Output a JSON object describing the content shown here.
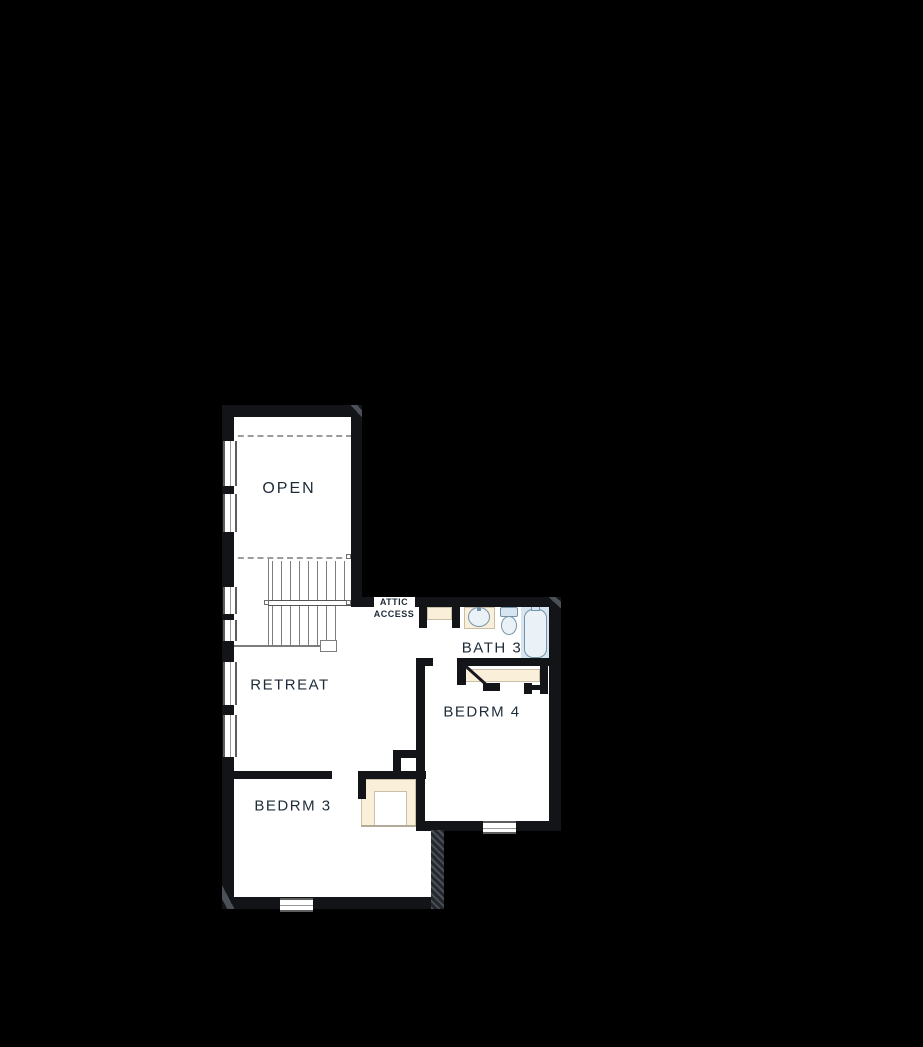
{
  "document": {
    "type": "floor-plan",
    "floor": "second-floor"
  },
  "labels": {
    "open": "OPEN",
    "retreat": "RETREAT",
    "bedrm3": "BEDRM 3",
    "bedrm4": "BEDRM 4",
    "bath3": "BATH 3",
    "attic_line1": "ATTIC",
    "attic_line2": "ACCESS"
  },
  "rooms": [
    "OPEN",
    "RETREAT",
    "BEDRM 3",
    "BEDRM 4",
    "BATH 3"
  ],
  "fixtures": [
    "stairs",
    "bathtub",
    "toilet",
    "vanity-sink",
    "closet-shelves",
    "attic-access-closet"
  ],
  "colors": {
    "bg": "#000000",
    "floor": "#ffffff",
    "wall": "#131418",
    "cream": "#faf0da",
    "blue": "#d7e5f0",
    "blue_light": "#eaf2f8",
    "blue_stroke": "#7493a9",
    "stair": "#7d7d7d",
    "dash": "#9c9c9c",
    "label": "#1f2b38"
  }
}
